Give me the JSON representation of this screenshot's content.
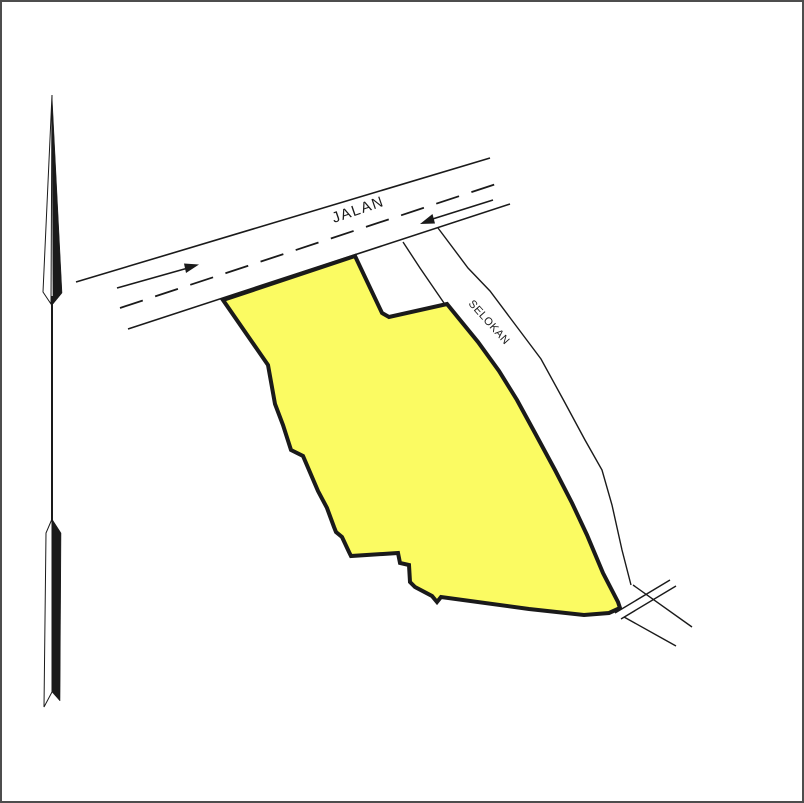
{
  "drawing": {
    "road_label": "JALAN",
    "ditch_label": "SELOKAN"
  },
  "icons": {
    "north_arrow": "north-needle",
    "road_direction_right": "arrow-northeast",
    "road_direction_left": "arrow-southwest",
    "culvert": "double-tick-crossing"
  },
  "colors": {
    "parcel_fill": "#FBFB62",
    "line": "#1a1a1a",
    "background": "#ffffff",
    "frame": "#4d4d4d"
  }
}
